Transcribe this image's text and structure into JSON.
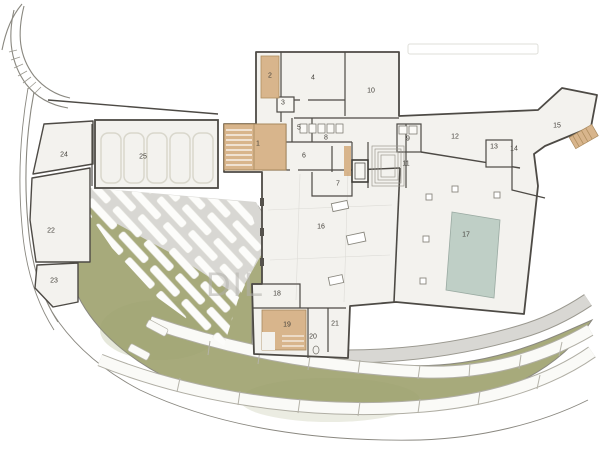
{
  "plan": {
    "title": "floor-plan",
    "watermark": "DIL",
    "rooms": [
      {
        "n": "1",
        "x": 258,
        "y": 144
      },
      {
        "n": "2",
        "x": 270,
        "y": 76
      },
      {
        "n": "3",
        "x": 283,
        "y": 103
      },
      {
        "n": "4",
        "x": 313,
        "y": 78
      },
      {
        "n": "5",
        "x": 299,
        "y": 128
      },
      {
        "n": "6",
        "x": 304,
        "y": 156
      },
      {
        "n": "7",
        "x": 338,
        "y": 184
      },
      {
        "n": "8",
        "x": 326,
        "y": 138
      },
      {
        "n": "9",
        "x": 408,
        "y": 139
      },
      {
        "n": "10",
        "x": 371,
        "y": 91
      },
      {
        "n": "11",
        "x": 406,
        "y": 164
      },
      {
        "n": "12",
        "x": 455,
        "y": 137
      },
      {
        "n": "13",
        "x": 494,
        "y": 147
      },
      {
        "n": "14",
        "x": 514,
        "y": 149
      },
      {
        "n": "15",
        "x": 557,
        "y": 126
      },
      {
        "n": "16",
        "x": 321,
        "y": 227
      },
      {
        "n": "17",
        "x": 466,
        "y": 235
      },
      {
        "n": "18",
        "x": 277,
        "y": 294
      },
      {
        "n": "19",
        "x": 287,
        "y": 325
      },
      {
        "n": "20",
        "x": 313,
        "y": 337
      },
      {
        "n": "21",
        "x": 335,
        "y": 324
      },
      {
        "n": "22",
        "x": 51,
        "y": 231
      },
      {
        "n": "23",
        "x": 54,
        "y": 281
      },
      {
        "n": "24",
        "x": 64,
        "y": 155
      },
      {
        "n": "25",
        "x": 143,
        "y": 157
      }
    ],
    "colors": {
      "lawn": "#a7aa7b",
      "pool": "#bfcfc6",
      "stairs_tan": "#d8b58c",
      "wall": "#4d4a45",
      "paving": "#d8d7d3",
      "room_fill": "#f3f2ee"
    }
  }
}
